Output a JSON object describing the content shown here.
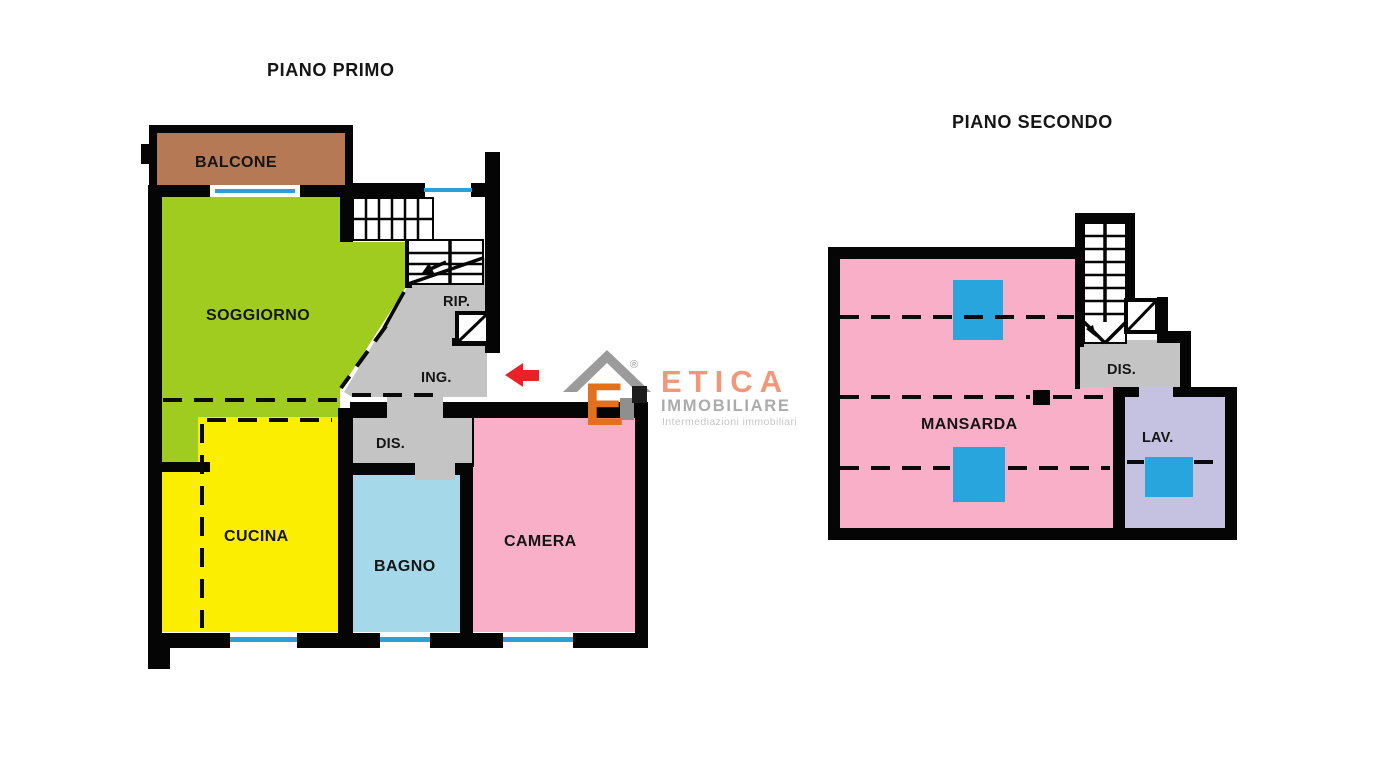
{
  "floor1": {
    "title": "PIANO PRIMO",
    "rooms": {
      "balcone": "BALCONE",
      "soggiorno": "SOGGIORNO",
      "rip": "RIP.",
      "ing": "ING.",
      "dis": "DIS.",
      "cucina": "CUCINA",
      "bagno": "BAGNO",
      "camera": "CAMERA"
    }
  },
  "floor2": {
    "title": "PIANO SECONDO",
    "rooms": {
      "mansarda": "MANSARDA",
      "dis": "DIS.",
      "lav": "LAV."
    }
  },
  "logo": {
    "monogram": "E",
    "registered": "®",
    "brand": "ETICA",
    "division": "IMMOBILIARE",
    "tagline": "Intermediazioni immobiliari"
  },
  "colors": {
    "wall": "#050505",
    "soggiorno_green": "#A0CB1F",
    "cucina_yellow": "#FCEE00",
    "camera_pink": "#F9AFC7",
    "mansarda_pink": "#F9AFC7",
    "bagno_lightblue": "#A5D8E8",
    "balcone_brown": "#B57A55",
    "lav_lavender": "#C5C1E1",
    "corridor_gray": "#C4C4C4",
    "skylight_blue": "#29A5DE",
    "window_blue": "#2B9FD8",
    "entrance_arrow_red": "#E82328",
    "logo_orange": "#E2711D",
    "logo_coral": "#F2987A",
    "logo_gray": "#ABABAB",
    "roof_gray": "#9B9B9B"
  }
}
